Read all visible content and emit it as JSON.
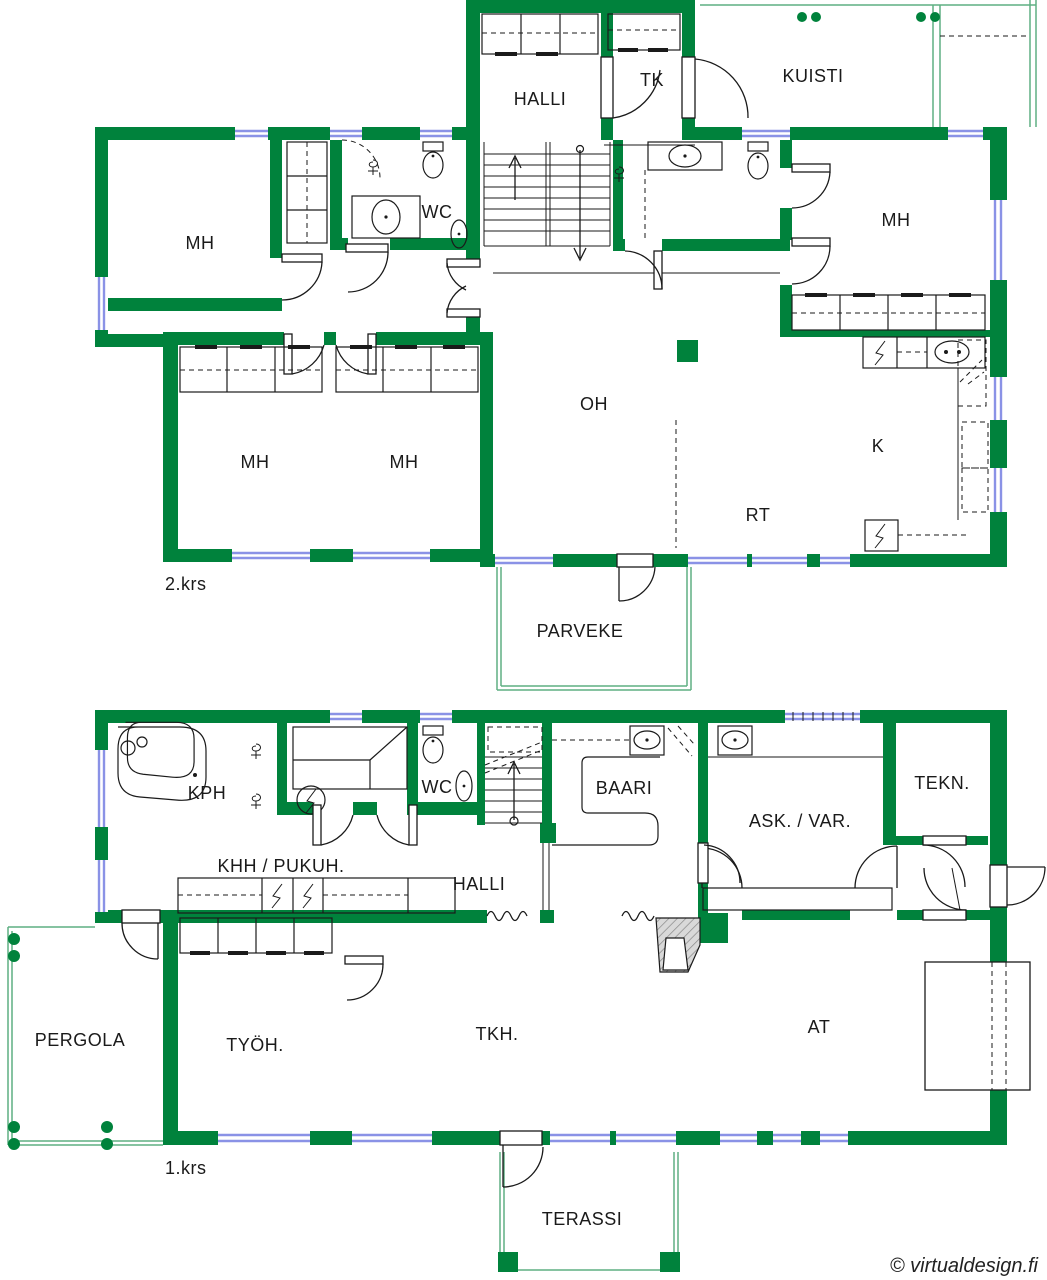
{
  "document": {
    "type": "floor-plan",
    "site_credit": "© virtualdesign.fi"
  },
  "colors": {
    "wall": "#00823C",
    "window": "#8A92E6",
    "porch": "#5FAF82",
    "ink": "#1A1A1A",
    "paper": "#FFFFFF",
    "hatch": "#9A9A9A",
    "hatch_bg": "#D9D9D9"
  },
  "labels": {
    "f2": {
      "floor": "2.krs",
      "halli": "HALLI",
      "tk": "TK",
      "kuisti": "KUISTI",
      "wc": "WC",
      "mh_nw": "MH",
      "mh_sw1": "MH",
      "mh_sw2": "MH",
      "mh_e": "MH",
      "oh": "OH",
      "rt": "RT",
      "k": "K",
      "parveke": "PARVEKE"
    },
    "f1": {
      "floor": "1.krs",
      "kph": "KPH",
      "khh": "KHH / PUKUH.",
      "wc": "WC",
      "halli": "HALLI",
      "baari": "BAARI",
      "ask": "ASK. / VAR.",
      "tekn": "TEKN.",
      "pergola": "PERGOLA",
      "tyoh": "TYÖH.",
      "tkh": "TKH.",
      "at": "AT",
      "terassi": "TERASSI"
    },
    "copyright": "© virtualdesign.fi"
  }
}
